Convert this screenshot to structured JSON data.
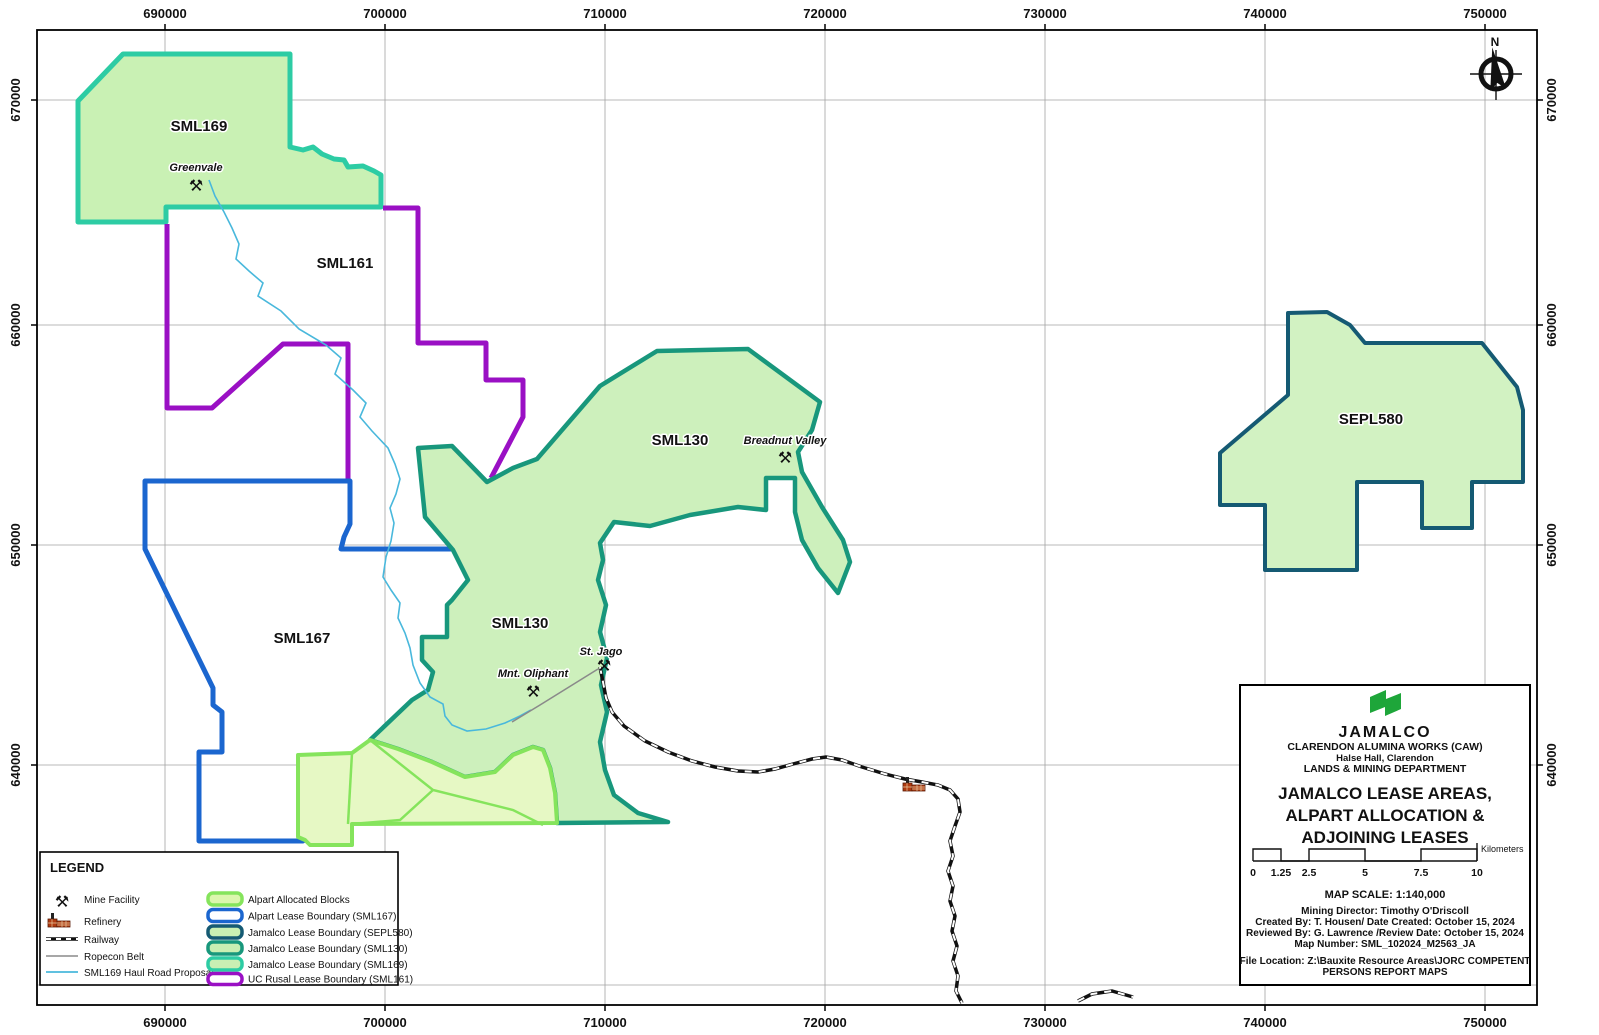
{
  "map": {
    "north_label": "N",
    "axes": {
      "x_ticks": [
        "690000",
        "700000",
        "710000",
        "720000",
        "730000",
        "740000",
        "750000"
      ],
      "y_ticks": [
        "670000",
        "660000",
        "650000",
        "640000"
      ]
    },
    "lease_labels": {
      "sml169": "SML169",
      "sml161": "SML161",
      "sml130_north": "SML130",
      "sml130_central": "SML130",
      "sml167": "SML167",
      "sepl580": "SEPL580"
    },
    "places": {
      "greenvale": "Greenvale",
      "breadnut_valley": "Breadnut Valley",
      "mnt_oliphant": "Mnt. Oliphant",
      "st_jago": "St. Jago"
    },
    "mine_symbol": "⚒"
  },
  "legend": {
    "title": "LEGEND",
    "symbol_items": [
      {
        "icon": "mine-facility-icon",
        "label": "Mine Facility"
      },
      {
        "icon": "refinery-icon",
        "label": "Refinery"
      },
      {
        "icon": "railway-icon",
        "label": "Railway"
      },
      {
        "icon": "ropecon-belt-icon",
        "label": "Ropecon Belt"
      },
      {
        "icon": "haul-road-icon",
        "label": "SML169 Haul Road Proposal"
      }
    ],
    "patch_items": [
      {
        "label": "Alpart Allocated Blocks",
        "fill": "#dcf6ae",
        "stroke": "#85e45c"
      },
      {
        "label": "Alpart Lease Boundary (SML167)",
        "fill": "#ffffff",
        "stroke": "#1b66cf"
      },
      {
        "label": "Jamalco Lease Boundary (SEPL580)",
        "fill": "#c9efb3",
        "stroke": "#155a73"
      },
      {
        "label": "Jamalco Lease Boundary (SML130)",
        "fill": "#c9efb3",
        "stroke": "#18977c"
      },
      {
        "label": "Jamalco Lease Boundary (SML169)",
        "fill": "#c9efb3",
        "stroke": "#2dcca4"
      },
      {
        "label": "UC Rusal Lease Boundary (SML161)",
        "fill": "#ffffff",
        "stroke": "#9a10c4"
      }
    ]
  },
  "title_block": {
    "org": "JAMALCO",
    "org_line2": "CLARENDON ALUMINA WORKS (CAW)",
    "org_line3": "Halse Hall, Clarendon",
    "org_line4": "LANDS & MINING DEPARTMENT",
    "title_line1": "JAMALCO LEASE AREAS,",
    "title_line2": "ALPART ALLOCATION &",
    "title_line3": "ADJOINING LEASES",
    "scalebar": {
      "ticks": [
        "0",
        "1.25",
        "2.5",
        "5",
        "7.5",
        "10"
      ],
      "unit": "Kilometers"
    },
    "map_scale": "MAP SCALE: 1:140,000",
    "credit_line1": "Mining Director: Timothy O'Driscoll",
    "credit_line2": "Created By: T. Housen/ Date Created: October 15, 2024",
    "credit_line3": "Reviewed By: G. Lawrence /Review Date: October 15, 2024",
    "credit_line4": "Map Number: SML_102024_M2563_JA",
    "file_location_line1": "File Location: Z:\\Bauxite Resource Areas\\JORC COMPETENT",
    "file_location_line2": "PERSONS REPORT MAPS"
  },
  "colors": {
    "sml169_boundary": "#2dcca4",
    "sml169_fill": "#c9f1b4",
    "sml130_boundary": "#18977c",
    "sml130_fill": "#cdf0bc",
    "sepl580_boundary": "#155a73",
    "sepl580_fill": "#d2f2c2",
    "sml167_boundary": "#1b66cf",
    "sml161_boundary": "#9a10c4",
    "alpart_fill": "#e6f8c4",
    "alpart_boundary": "#85e45c",
    "haul_road": "#49b8dc",
    "ropecon": "#8a8a8a",
    "grid": "#a3a3a3",
    "logo_green": "#1ea63a",
    "refinery_red": "#b03a10"
  }
}
